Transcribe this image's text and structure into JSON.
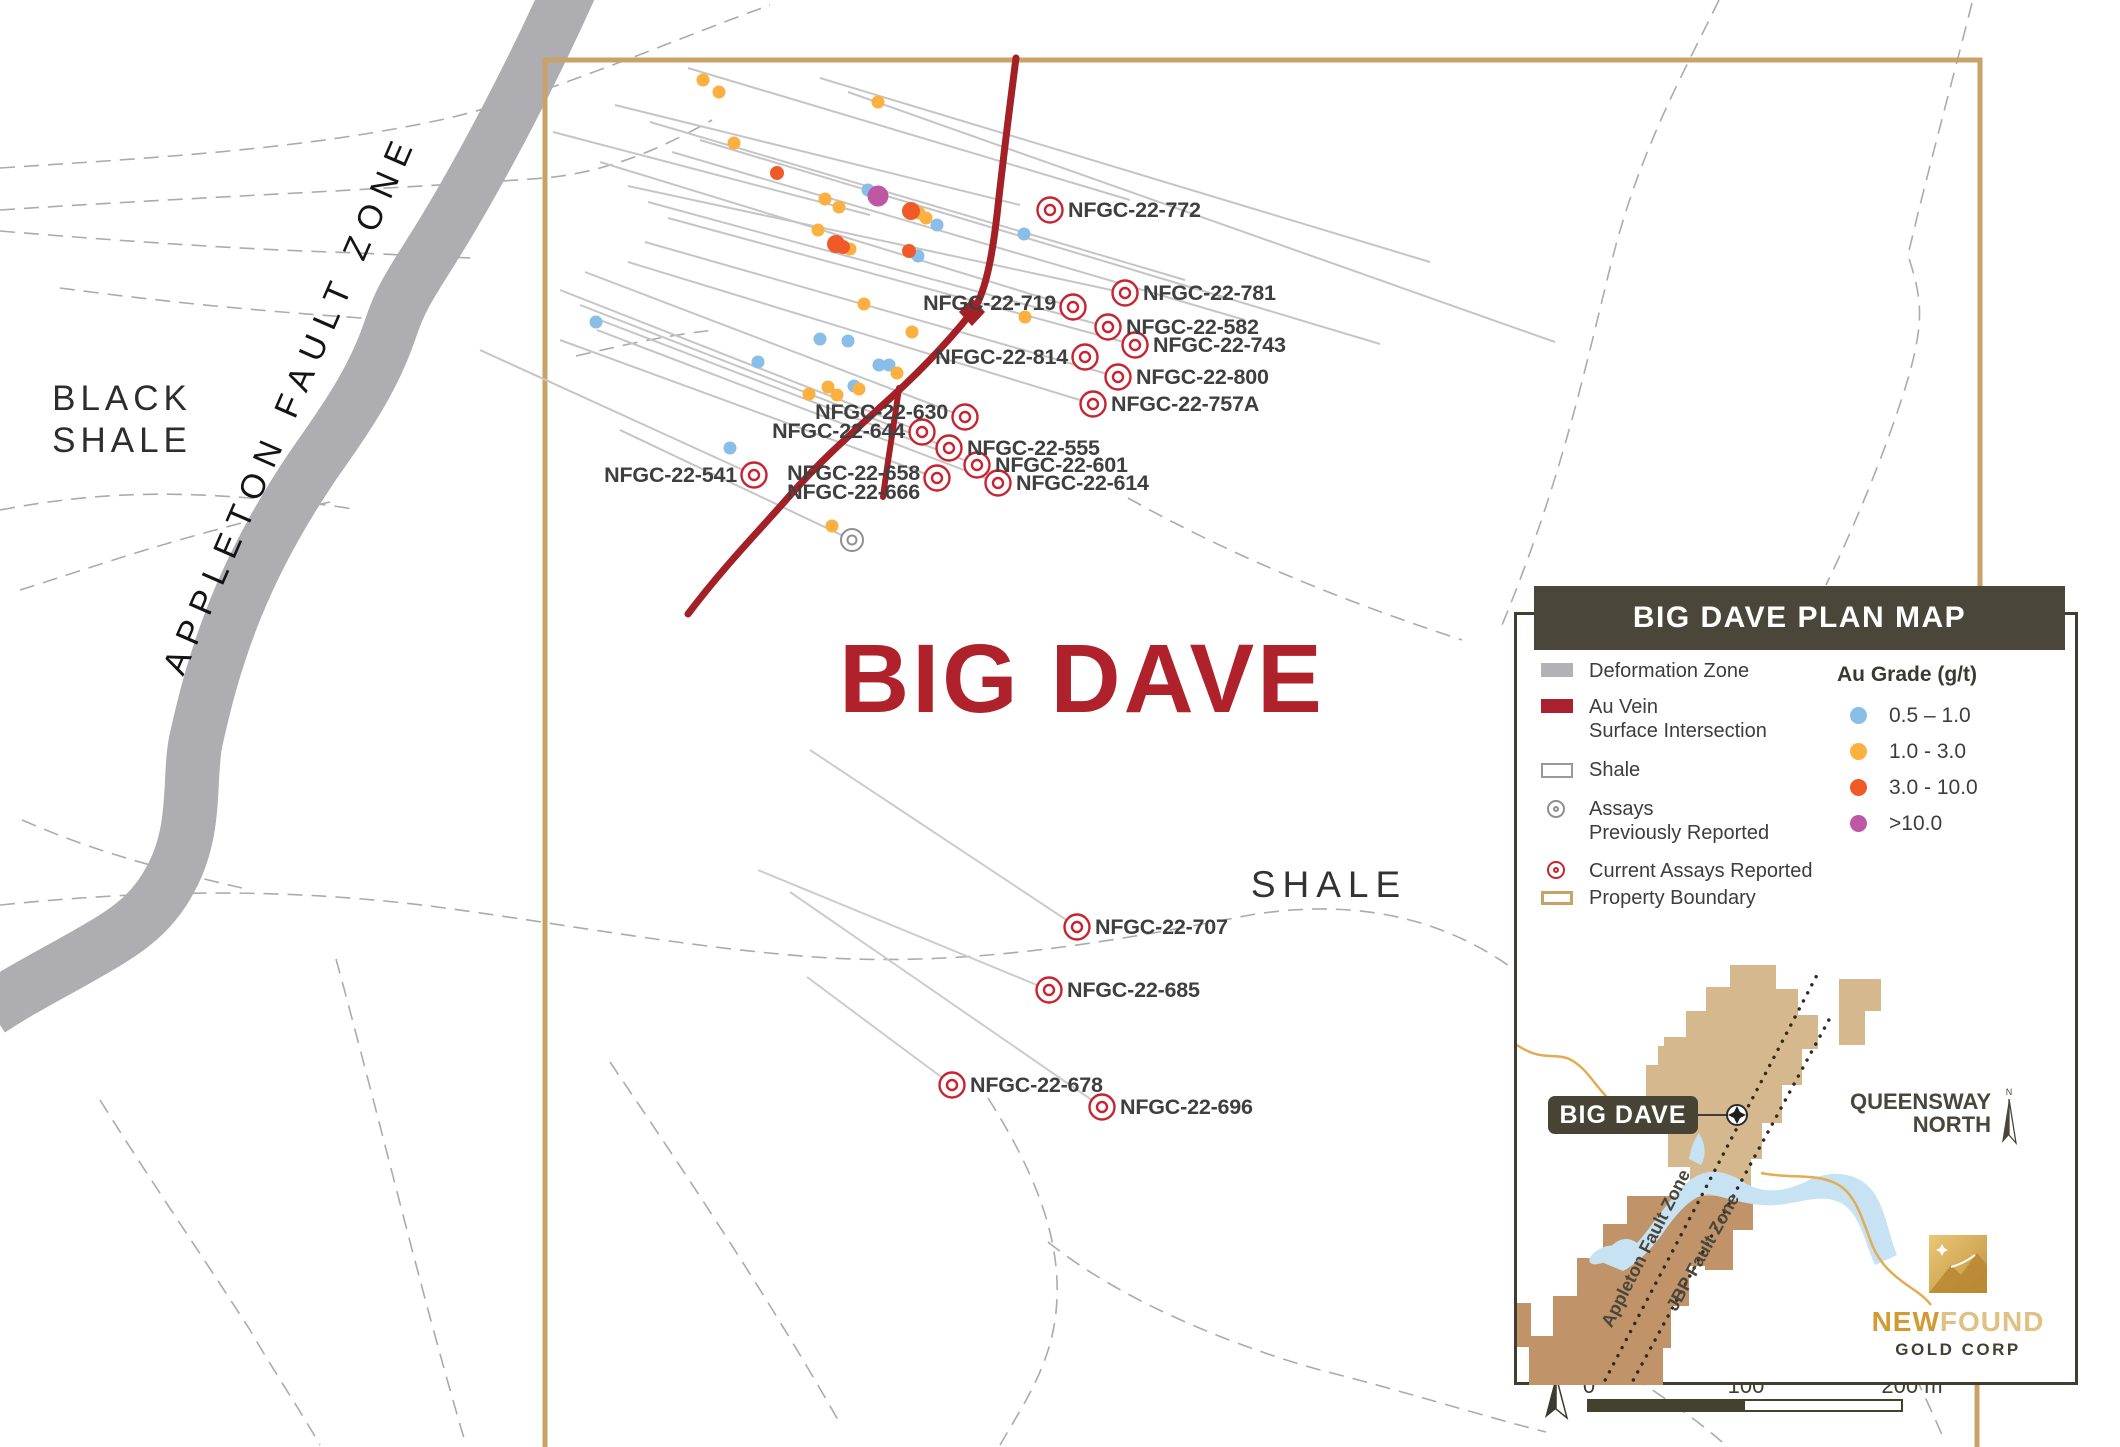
{
  "map": {
    "big_dave": "BIG DAVE",
    "shale": "SHALE",
    "black_shale": {
      "line1": "BLACK",
      "line2": "SHALE"
    },
    "appleton": "APPLETON FAULT ZONE"
  },
  "holes": [
    {
      "label": "NFGC-22-772"
    },
    {
      "label": "NFGC-22-781"
    },
    {
      "label": "NFGC-22-582"
    },
    {
      "label": "NFGC-22-743"
    },
    {
      "label": "NFGC-22-800"
    },
    {
      "label": "NFGC-22-757A"
    },
    {
      "label": "NFGC-22-719"
    },
    {
      "label": "NFGC-22-814"
    },
    {
      "label": "NFGC-22-630"
    },
    {
      "label": "NFGC-22-644"
    },
    {
      "label": "NFGC-22-555"
    },
    {
      "label": "NFGC-22-601"
    },
    {
      "label": "NFGC-22-658"
    },
    {
      "label": "NFGC-22-666"
    },
    {
      "label": "NFGC-22-614"
    },
    {
      "label": "NFGC-22-541"
    },
    {
      "label": "NFGC-22-707"
    },
    {
      "label": "NFGC-22-685"
    },
    {
      "label": "NFGC-22-678"
    },
    {
      "label": "NFGC-22-696"
    }
  ],
  "legend": {
    "title": "BIG DAVE PLAN MAP",
    "items": [
      {
        "label": "Deformation Zone"
      },
      {
        "line1": "Au Vein",
        "line2": "Surface Intersection"
      },
      {
        "label": "Shale"
      },
      {
        "line1": "Assays",
        "line2": "Previously Reported"
      },
      {
        "label": "Current Assays Reported"
      },
      {
        "label": "Property Boundary"
      }
    ],
    "au_grade": {
      "title": "Au Grade (g/t)",
      "classes": [
        {
          "range": "0.5 – 1.0",
          "color": "#88bee8"
        },
        {
          "range": "1.0 - 3.0",
          "color": "#fbb040"
        },
        {
          "range": "3.0 - 10.0",
          "color": "#f05a28"
        },
        {
          "range": ">10.0",
          "color": "#be58a5"
        }
      ]
    }
  },
  "inset": {
    "big_dave": "BIG DAVE",
    "queensway": {
      "line1": "QUEENSWAY",
      "line2": "NORTH"
    },
    "faults": [
      "Appleton Fault Zone",
      "JBP Fault Zone"
    ],
    "logo": {
      "new_part": "NEW",
      "found_part": "FOUND",
      "sub": "GOLD CORP"
    },
    "north": "N"
  },
  "scalebar": {
    "t0": "0",
    "t100": "100",
    "t200": "200 m"
  },
  "compass": {
    "n": "N"
  },
  "colors": {
    "vein": "#a32026",
    "boundary": "#c8a266",
    "title_red": "#b0222b",
    "deformation_band": "#adadb2",
    "marker_current": "#c82331",
    "marker_previous": "#8f8f8f",
    "grade_blue": "#88bee8",
    "grade_orange": "#fbb040",
    "grade_red": "#f05a28",
    "grade_purple": "#be58a5",
    "legend_dark": "#4a463a"
  }
}
